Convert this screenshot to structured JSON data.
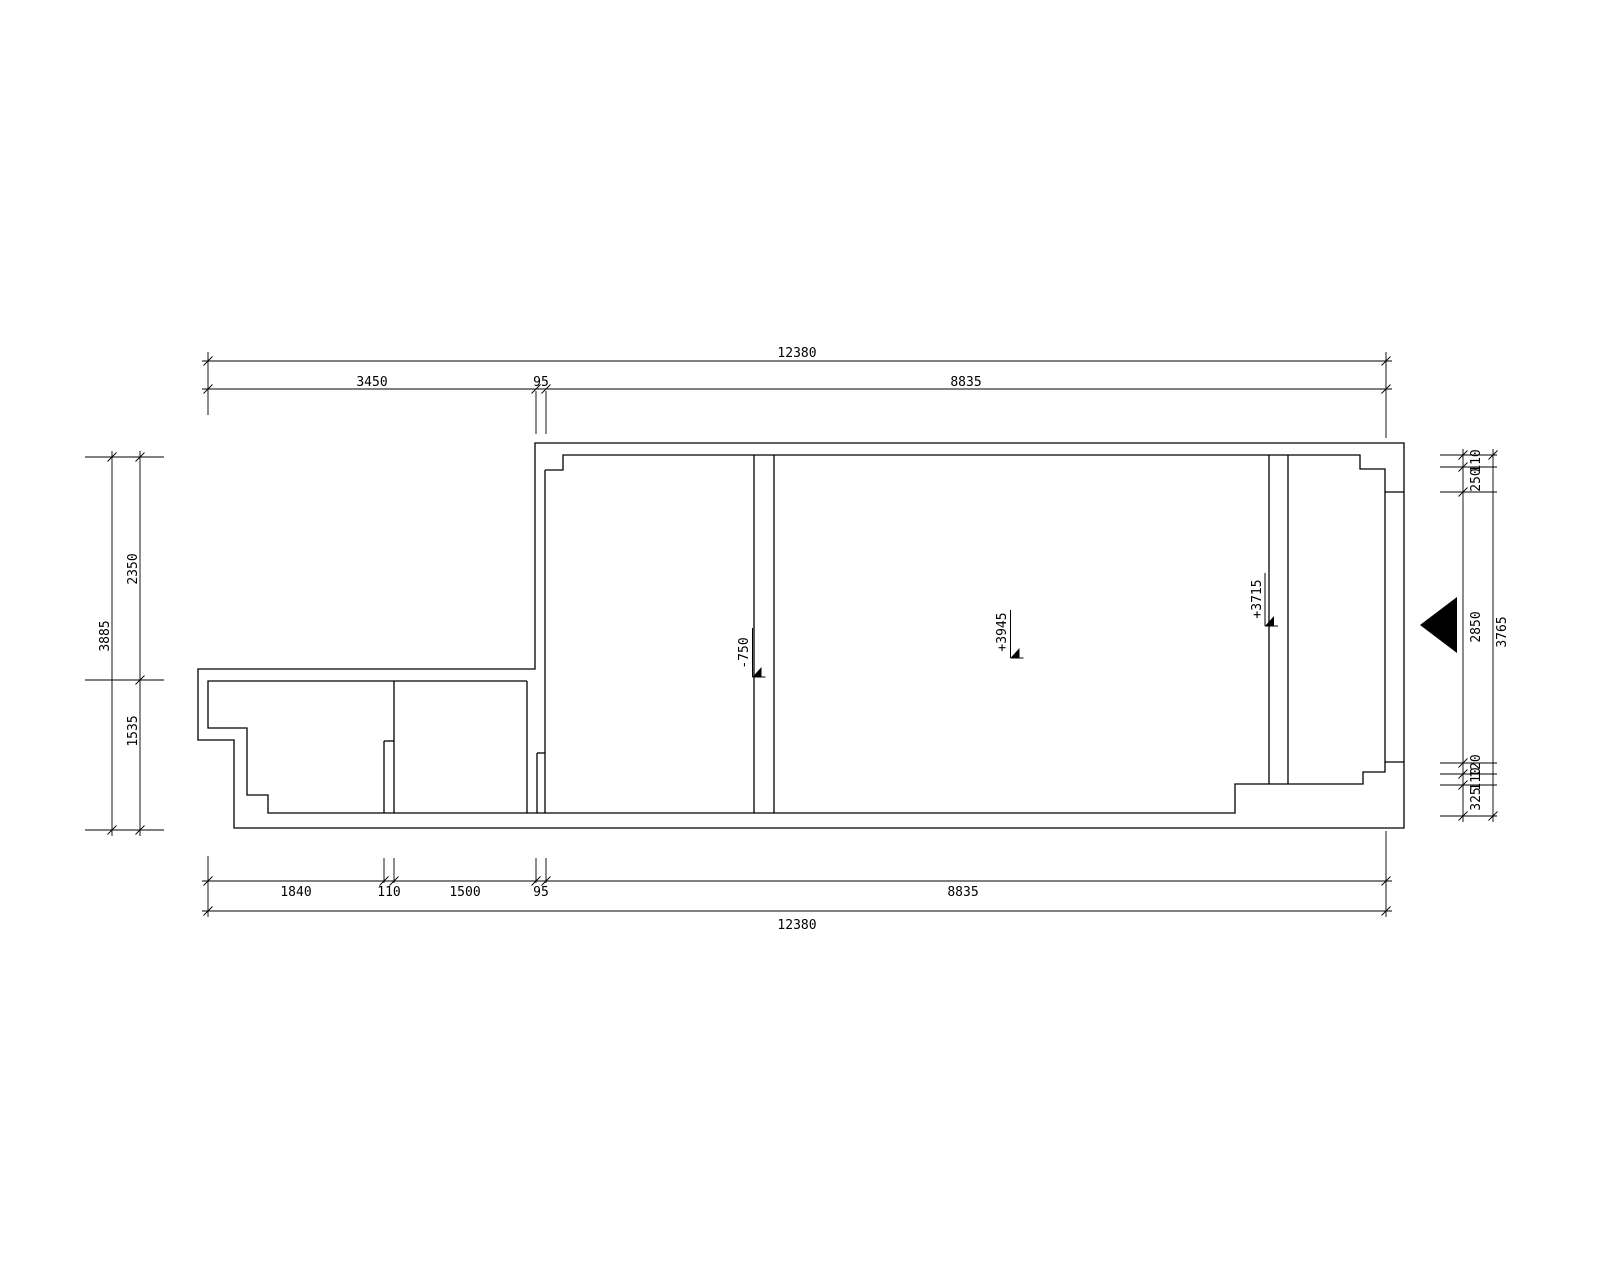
{
  "style": {
    "background": "#ffffff",
    "line_color": "#000000",
    "text_color": "#000000",
    "wall_stroke": 1.3,
    "dim_stroke": 0.9,
    "font_size": 13
  },
  "drawing": {
    "outer_wall": [
      [
        535,
        443
      ],
      [
        1404,
        443
      ],
      [
        1404,
        828
      ],
      [
        234,
        828
      ],
      [
        234,
        740
      ],
      [
        198,
        740
      ],
      [
        198,
        669
      ],
      [
        535,
        669
      ],
      [
        535,
        443
      ]
    ],
    "inner_walls": [
      [
        [
          545,
          470
        ],
        [
          563,
          470
        ],
        [
          563,
          455
        ],
        [
          1360,
          455
        ],
        [
          1360,
          469
        ],
        [
          1385,
          469
        ],
        [
          1385,
          772
        ],
        [
          1363,
          772
        ],
        [
          1363,
          784
        ],
        [
          1235,
          784
        ],
        [
          1235,
          813
        ],
        [
          268,
          813
        ],
        [
          268,
          795
        ],
        [
          247,
          795
        ],
        [
          247,
          728
        ],
        [
          208,
          728
        ],
        [
          208,
          681
        ],
        [
          527,
          681
        ]
      ],
      [
        [
          1385,
          492
        ],
        [
          1404,
          492
        ]
      ],
      [
        [
          1385,
          762
        ],
        [
          1404,
          762
        ]
      ],
      [
        [
          545,
          470
        ],
        [
          545,
          813
        ]
      ],
      [
        [
          384,
          741
        ],
        [
          384,
          813
        ]
      ],
      [
        [
          394,
          681
        ],
        [
          394,
          813
        ]
      ],
      [
        [
          384,
          741
        ],
        [
          394,
          741
        ]
      ],
      [
        [
          527,
          681
        ],
        [
          527,
          813
        ]
      ],
      [
        [
          537,
          753
        ],
        [
          537,
          813
        ]
      ],
      [
        [
          537,
          753
        ],
        [
          545,
          753
        ]
      ],
      [
        [
          754,
          455
        ],
        [
          754,
          813
        ]
      ],
      [
        [
          774,
          455
        ],
        [
          774,
          813
        ]
      ],
      [
        [
          1269,
          455
        ],
        [
          1269,
          784
        ]
      ],
      [
        [
          1288,
          455
        ],
        [
          1288,
          784
        ]
      ]
    ],
    "extension_lines": [
      [
        208,
        352,
        208,
        415
      ],
      [
        536,
        391,
        536,
        434
      ],
      [
        546,
        391,
        546,
        434
      ],
      [
        1386,
        352,
        1386,
        438
      ],
      [
        208,
        856,
        208,
        917
      ],
      [
        384,
        858,
        384,
        883
      ],
      [
        394,
        858,
        394,
        883
      ],
      [
        536,
        858,
        536,
        883
      ],
      [
        546,
        858,
        546,
        883
      ],
      [
        1386,
        831,
        1386,
        917
      ],
      [
        85,
        457,
        164,
        457
      ],
      [
        85,
        680,
        164,
        680
      ],
      [
        85,
        830,
        164,
        830
      ],
      [
        1440,
        455,
        1497,
        455
      ],
      [
        1440,
        467,
        1497,
        467
      ],
      [
        1440,
        492,
        1497,
        492
      ],
      [
        1440,
        763,
        1497,
        763
      ],
      [
        1440,
        774,
        1497,
        774
      ],
      [
        1440,
        785,
        1497,
        785
      ],
      [
        1440,
        816,
        1497,
        816
      ]
    ],
    "dimension_chains": [
      {
        "dir": "h",
        "pos": 361,
        "from": 208,
        "to": 1386,
        "ticks": [
          208,
          1386
        ],
        "labels": [
          {
            "t": "12380",
            "x": 797,
            "y": 357,
            "rot": false
          }
        ]
      },
      {
        "dir": "h",
        "pos": 389,
        "from": 208,
        "to": 1386,
        "ticks": [
          208,
          536,
          546,
          1386
        ],
        "labels": [
          {
            "t": "3450",
            "x": 372,
            "y": 386,
            "rot": false
          },
          {
            "t": "95",
            "x": 541,
            "y": 386,
            "rot": false
          },
          {
            "t": "8835",
            "x": 966,
            "y": 386,
            "rot": false
          }
        ]
      },
      {
        "dir": "h",
        "pos": 881,
        "from": 208,
        "to": 1386,
        "ticks": [
          208,
          384,
          394,
          536,
          546,
          1386
        ],
        "labels": [
          {
            "t": "1840",
            "x": 296,
            "y": 896,
            "rot": false
          },
          {
            "t": "110",
            "x": 389,
            "y": 896,
            "rot": false
          },
          {
            "t": "1500",
            "x": 465,
            "y": 896,
            "rot": false
          },
          {
            "t": "95",
            "x": 541,
            "y": 896,
            "rot": false
          },
          {
            "t": "8835",
            "x": 963,
            "y": 896,
            "rot": false
          }
        ]
      },
      {
        "dir": "h",
        "pos": 911,
        "from": 208,
        "to": 1386,
        "ticks": [
          208,
          1386
        ],
        "labels": [
          {
            "t": "12380",
            "x": 797,
            "y": 929,
            "rot": false
          }
        ]
      },
      {
        "dir": "v",
        "pos": 112,
        "from": 457,
        "to": 830,
        "ticks": [
          457,
          830
        ],
        "labels": [
          {
            "t": "3885",
            "x": 109,
            "y": 636,
            "rot": true
          }
        ]
      },
      {
        "dir": "v",
        "pos": 140,
        "from": 457,
        "to": 830,
        "ticks": [
          457,
          680,
          830
        ],
        "labels": [
          {
            "t": "2350",
            "x": 137,
            "y": 569,
            "rot": true
          },
          {
            "t": "1535",
            "x": 137,
            "y": 731,
            "rot": true
          }
        ]
      },
      {
        "dir": "v",
        "pos": 1463,
        "from": 455,
        "to": 816,
        "ticks": [
          455,
          467,
          492,
          763,
          774,
          785,
          816
        ],
        "labels": [
          {
            "t": "110",
            "x": 1480,
            "y": 461,
            "rot": true
          },
          {
            "t": "250",
            "x": 1480,
            "y": 480,
            "rot": true
          },
          {
            "t": "2850",
            "x": 1480,
            "y": 627,
            "rot": true
          },
          {
            "t": "120",
            "x": 1480,
            "y": 766,
            "rot": true
          },
          {
            "t": "110",
            "x": 1480,
            "y": 779,
            "rot": true
          },
          {
            "t": "325",
            "x": 1480,
            "y": 799,
            "rot": true
          }
        ]
      },
      {
        "dir": "v",
        "pos": 1493,
        "from": 455,
        "to": 816,
        "ticks": [
          455,
          816
        ],
        "labels": [
          {
            "t": "3765",
            "x": 1506,
            "y": 632,
            "rot": true
          }
        ]
      }
    ],
    "elevation_markers": [
      {
        "text": "-750",
        "x": 752.5,
        "y1": 628,
        "y2": 677,
        "tx": 748,
        "ty": 653
      },
      {
        "text": "+3945",
        "x": 1010.5,
        "y1": 610,
        "y2": 658,
        "tx": 1006,
        "ty": 632
      },
      {
        "text": "+3715",
        "x": 1265,
        "y1": 573,
        "y2": 626,
        "tx": 1261,
        "ty": 599
      }
    ],
    "entrance_arrow": {
      "points": [
        [
          1420,
          625
        ],
        [
          1457,
          597
        ],
        [
          1457,
          653
        ]
      ]
    }
  }
}
